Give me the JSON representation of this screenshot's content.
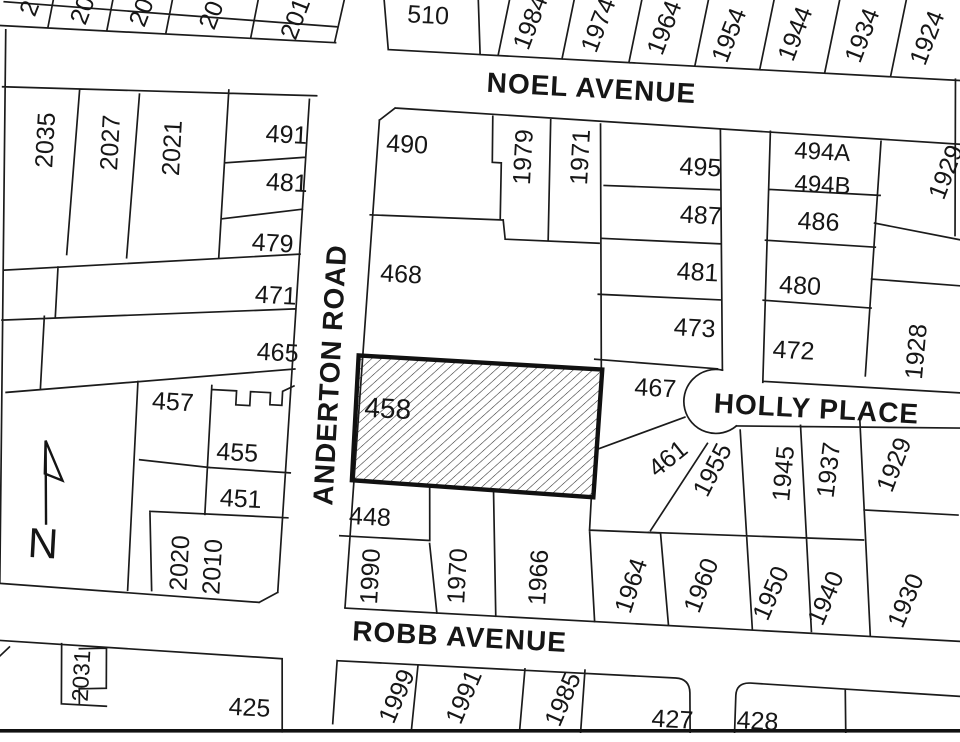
{
  "map_type": "cadastral parcel map",
  "colors": {
    "background": "#ffffff",
    "linework": "#1b1b1b",
    "subject_parcel_border": "#111111",
    "subject_parcel_hatch": "#2a2a2a"
  },
  "streets": [
    {
      "name": "NOEL AVENUE",
      "x": 576,
      "y": 82,
      "rot": 0,
      "fs": 28
    },
    {
      "name": "ANDERTON ROAD",
      "x": 330,
      "y": 383,
      "rot": -90,
      "fs": 28
    },
    {
      "name": "HOLLY PLACE",
      "x": 818,
      "y": 390,
      "rot": 0,
      "fs": 28
    },
    {
      "name": "ROBB AVENUE",
      "x": 474,
      "y": 637,
      "rot": 0,
      "fs": 28
    }
  ],
  "north_arrow": {
    "label": "N"
  },
  "subject_parcel": {
    "label": "458"
  },
  "lots": [
    {
      "label": "2",
      "x": 10,
      "y": 33,
      "rot": -72
    },
    {
      "label": "20",
      "x": 63,
      "y": 32,
      "rot": -72
    },
    {
      "label": "20",
      "x": 122,
      "y": 31,
      "rot": -72
    },
    {
      "label": "20",
      "x": 192,
      "y": 30,
      "rot": -72
    },
    {
      "label": "201",
      "x": 276,
      "y": 29,
      "rot": -72
    },
    {
      "label": "510",
      "x": 409,
      "y": 18,
      "rot": 0
    },
    {
      "label": "1984",
      "x": 511,
      "y": 20,
      "rot": -72
    },
    {
      "label": "1974",
      "x": 579,
      "y": 19,
      "rot": -72
    },
    {
      "label": "1964",
      "x": 645,
      "y": 18,
      "rot": -72
    },
    {
      "label": "1954",
      "x": 710,
      "y": 22,
      "rot": -72
    },
    {
      "label": "1944",
      "x": 776,
      "y": 17,
      "rot": -72
    },
    {
      "label": "1934",
      "x": 843,
      "y": 15,
      "rot": -72
    },
    {
      "label": "1924",
      "x": 908,
      "y": 14,
      "rot": -72
    },
    {
      "label": "2035",
      "x": 33,
      "y": 164,
      "rot": -90
    },
    {
      "label": "2027",
      "x": 98,
      "y": 163,
      "rot": -90
    },
    {
      "label": "2021",
      "x": 160,
      "y": 165,
      "rot": -90
    },
    {
      "label": "491",
      "x": 274,
      "y": 145,
      "rot": 0
    },
    {
      "label": "481",
      "x": 277,
      "y": 193,
      "rot": 0
    },
    {
      "label": "479",
      "x": 266,
      "y": 254,
      "rot": 0
    },
    {
      "label": "471",
      "x": 272,
      "y": 306,
      "rot": 0
    },
    {
      "label": "465",
      "x": 277,
      "y": 363,
      "rot": 0
    },
    {
      "label": "457",
      "x": 175,
      "y": 418,
      "rot": 0
    },
    {
      "label": "455",
      "x": 242,
      "y": 465,
      "rot": 0
    },
    {
      "label": "451",
      "x": 248,
      "y": 511,
      "rot": 0
    },
    {
      "label": "2020",
      "x": 190,
      "y": 579,
      "rot": -90
    },
    {
      "label": "2010",
      "x": 223,
      "y": 581,
      "rot": -90
    },
    {
      "label": "2031",
      "x": 98,
      "y": 697,
      "rot": -90,
      "fs": 23
    },
    {
      "label": "425",
      "x": 268,
      "y": 719,
      "rot": 0
    },
    {
      "label": "490",
      "x": 395,
      "y": 148,
      "rot": 0
    },
    {
      "label": "1979",
      "x": 511,
      "y": 155,
      "rot": -90
    },
    {
      "label": "1971",
      "x": 568,
      "y": 152,
      "rot": -90
    },
    {
      "label": "468",
      "x": 396,
      "y": 278,
      "rot": 0
    },
    {
      "label": "448",
      "x": 378,
      "y": 522,
      "rot": 0
    },
    {
      "label": "1990",
      "x": 381,
      "y": 582,
      "rot": -90
    },
    {
      "label": "1970",
      "x": 468,
      "y": 577,
      "rot": -90
    },
    {
      "label": "1966",
      "x": 549,
      "y": 574,
      "rot": -90
    },
    {
      "label": "495",
      "x": 689,
      "y": 155,
      "rot": 0
    },
    {
      "label": "487",
      "x": 692,
      "y": 203,
      "rot": 0
    },
    {
      "label": "481",
      "x": 692,
      "y": 260,
      "rot": 0
    },
    {
      "label": "473",
      "x": 692,
      "y": 316,
      "rot": 0
    },
    {
      "label": "467",
      "x": 656,
      "y": 378,
      "rot": 0
    },
    {
      "label": "461",
      "x": 672,
      "y": 448,
      "rot": -42
    },
    {
      "label": "494A",
      "x": 810,
      "y": 133,
      "rot": 0,
      "fs": 24
    },
    {
      "label": "494B",
      "x": 812,
      "y": 166,
      "rot": 0,
      "fs": 24
    },
    {
      "label": "486",
      "x": 810,
      "y": 203,
      "rot": 0
    },
    {
      "label": "480",
      "x": 795,
      "y": 268,
      "rot": 0
    },
    {
      "label": "472",
      "x": 792,
      "y": 333,
      "rot": 0
    },
    {
      "label": "1929",
      "x": 934,
      "y": 147,
      "rot": -72
    },
    {
      "label": "1928",
      "x": 914,
      "y": 328,
      "rot": -88
    },
    {
      "label": "1955",
      "x": 717,
      "y": 457,
      "rot": -66
    },
    {
      "label": "1945",
      "x": 788,
      "y": 457,
      "rot": -88
    },
    {
      "label": "1937",
      "x": 833,
      "y": 451,
      "rot": -86
    },
    {
      "label": "1929",
      "x": 898,
      "y": 442,
      "rot": -72
    },
    {
      "label": "1964",
      "x": 642,
      "y": 577,
      "rot": -75
    },
    {
      "label": "1960",
      "x": 712,
      "y": 573,
      "rot": -72
    },
    {
      "label": "1950",
      "x": 782,
      "y": 577,
      "rot": -70
    },
    {
      "label": "1940",
      "x": 837,
      "y": 579,
      "rot": -70
    },
    {
      "label": "1930",
      "x": 917,
      "y": 577,
      "rot": -70
    },
    {
      "label": "1999",
      "x": 414,
      "y": 700,
      "rot": -70
    },
    {
      "label": "1991",
      "x": 481,
      "y": 697,
      "rot": -70
    },
    {
      "label": "1985",
      "x": 580,
      "y": 694,
      "rot": -70
    },
    {
      "label": "427",
      "x": 691,
      "y": 708,
      "rot": 0
    },
    {
      "label": "428",
      "x": 776,
      "y": 705,
      "rot": 0
    }
  ]
}
